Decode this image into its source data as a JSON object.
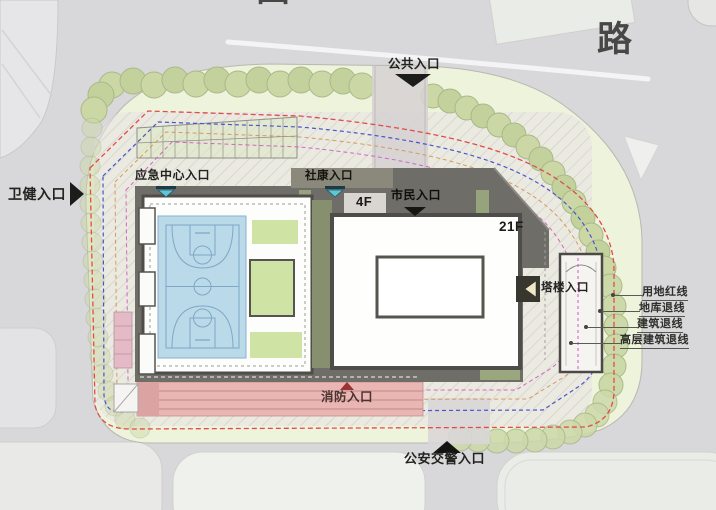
{
  "roads": {
    "top_name_partial": "田",
    "top_name_suffix": "路"
  },
  "entrances": {
    "public": "公共入口",
    "health": "卫健入口",
    "emergency_center": "应急中心入口",
    "community_clinic": "社康入口",
    "citizen": "市民入口",
    "tower": "塔楼入口",
    "fire": "消防入口",
    "traffic_police": "公安交警入口"
  },
  "buildings": {
    "podium_floors": "4F",
    "tower_floors": "21F"
  },
  "legend": {
    "items": [
      {
        "label": "用地红线",
        "line_color": "#e14b4b",
        "line_style": "dashed"
      },
      {
        "label": "地库退线",
        "line_color": "#4a55cc",
        "line_style": "dashed"
      },
      {
        "label": "建筑退线",
        "line_color": "#d4914f",
        "line_style": "dashed"
      },
      {
        "label": "高层建筑退线",
        "line_color": "#cf58c0",
        "line_style": "dashed"
      }
    ]
  },
  "colors": {
    "road_gray": "#d8d7d9",
    "site_green": "#eef3dc",
    "tree_green": "#cbd8a6",
    "court_blue": "#badaea",
    "lawn_green": "#cfe3a4",
    "fire_lane_pink": "#e9b6b4",
    "podium_roof_gray": "#6e6d68",
    "entrance_marker_black": "#1c1c1a",
    "entrance_marker_teal": "#5fc4d4",
    "fire_marker_red": "#9c3232"
  }
}
